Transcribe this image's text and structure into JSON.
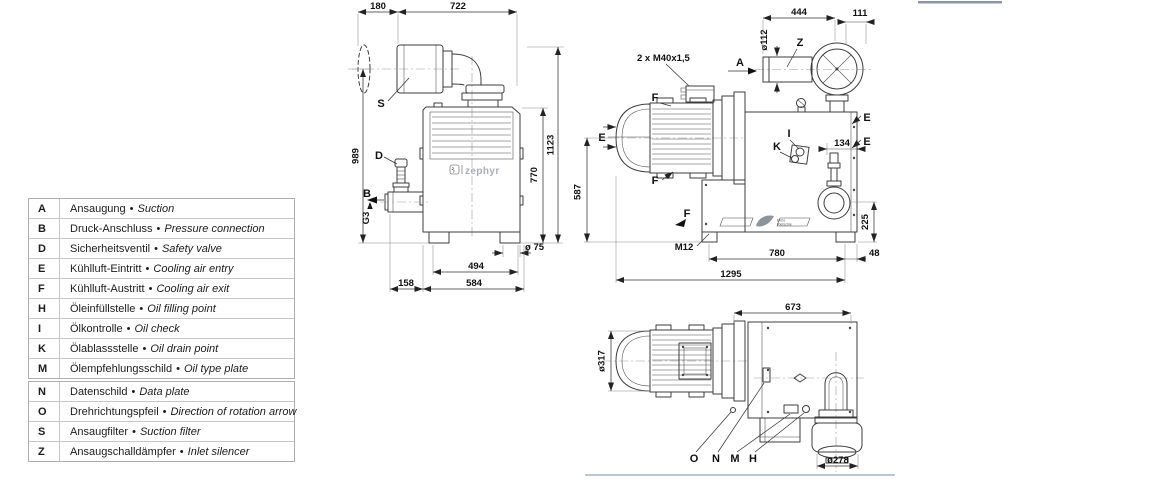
{
  "legend": {
    "bullet": "•",
    "group1": [
      {
        "key": "A",
        "de": "Ansaugung",
        "en": "Suction"
      },
      {
        "key": "B",
        "de": "Druck-Anschluss",
        "en": "Pressure connection"
      },
      {
        "key": "D",
        "de": "Sicherheitsventil",
        "en": "Safety valve"
      },
      {
        "key": "E",
        "de": "Kühlluft-Eintritt",
        "en": "Cooling air entry"
      },
      {
        "key": "F",
        "de": "Kühlluft-Austritt",
        "en": "Cooling air exit"
      },
      {
        "key": "H",
        "de": "Öleinfüllstelle",
        "en": "Oil filling point"
      },
      {
        "key": "I",
        "de": "Ölkontrolle",
        "en": "Oil check"
      },
      {
        "key": "K",
        "de": "Ölablassstelle",
        "en": "Oil drain point"
      },
      {
        "key": "M",
        "de": "Ölempfehlungsschild",
        "en": "Oil type plate"
      }
    ],
    "group2": [
      {
        "key": "N",
        "de": "Datenschild",
        "en": "Data plate"
      },
      {
        "key": "O",
        "de": "Drehrichtungspfeil",
        "en": "Direction of rotation arrow"
      },
      {
        "key": "S",
        "de": "Ansaugfilter",
        "en": "Suction filter"
      },
      {
        "key": "Z",
        "de": "Ansaugschalldämpfer",
        "en": "Inlet silencer"
      }
    ]
  },
  "front_view": {
    "brand": "zephyr",
    "labels": {
      "s": "S",
      "d": "D",
      "b": "B"
    },
    "dims": {
      "overhang": "180",
      "width_top": "722",
      "height_total": "1123",
      "height_left": "989",
      "height_body": "770",
      "thread": "G3",
      "port_dia": "ø 75",
      "feet_span": "494",
      "valve_offset": "158",
      "width_body": "584"
    }
  },
  "side_view": {
    "brand_line1": "Elmo",
    "brand_line2": "Rietschle",
    "labels": {
      "a": "A",
      "z": "Z",
      "e": "E",
      "f": "F",
      "i": "I",
      "k": "K"
    },
    "dims": {
      "cable_gland": "2 x M40x1,5",
      "silencer_len": "444",
      "end_offset": "111",
      "pipe_dia": "ø112",
      "sight_offset": "134",
      "drain_height": "225",
      "axis_height": "587",
      "foot_thread": "M12",
      "feet_span": "780",
      "overhang": "48",
      "total_length": "1295"
    }
  },
  "top_view": {
    "labels": {
      "o": "O",
      "n": "N",
      "m": "M",
      "h": "H"
    },
    "dims": {
      "length": "673",
      "motor_dia": "ø317",
      "silencer_dia": "ø278"
    }
  }
}
